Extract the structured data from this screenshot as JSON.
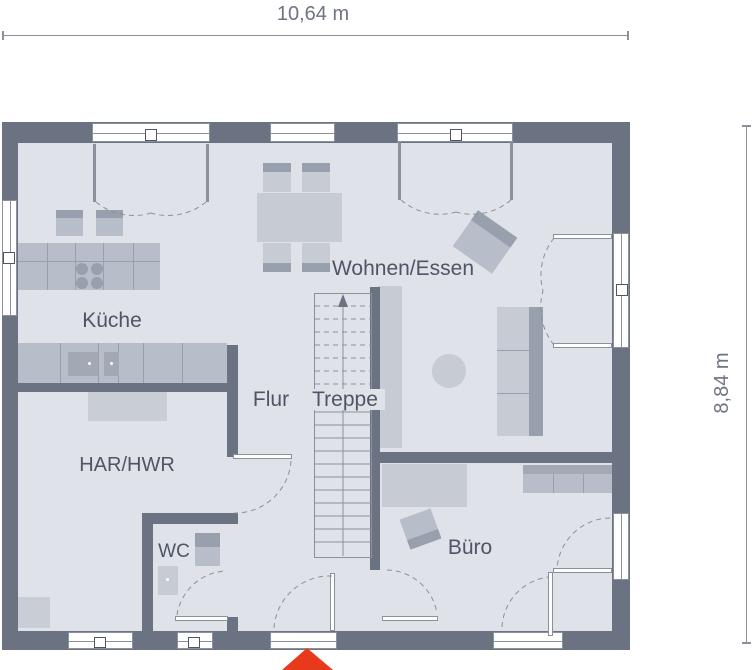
{
  "dimensions": {
    "width_label": "10,64 m",
    "height_label": "8,84 m"
  },
  "rooms": {
    "kueche": {
      "label": "Küche"
    },
    "wohnen_essen": {
      "label": "Wohnen/Essen"
    },
    "flur": {
      "label": "Flur"
    },
    "treppe": {
      "label": "Treppe"
    },
    "har_hwr": {
      "label": "HAR/HWR"
    },
    "wc": {
      "label": "WC"
    },
    "buero": {
      "label": "Büro"
    }
  },
  "icons": {
    "entrance_arrow": "red-triangle-entrance-marker",
    "stair_direction_arrow": "up-arrow"
  },
  "colors": {
    "wall": "#6b7382",
    "floor": "#dfe2e8",
    "furniture": "#c6cbd4",
    "furniture-mid": "#b8bec9",
    "furniture-light": "#c9ced6",
    "furniture-dark": "#98a0ad",
    "appliance": "#a2a9b5",
    "line": "#8a919c",
    "text": "#4e5565",
    "dim": "#6e7480",
    "dim-line": "#8a919c",
    "accent": "#e8391c"
  }
}
